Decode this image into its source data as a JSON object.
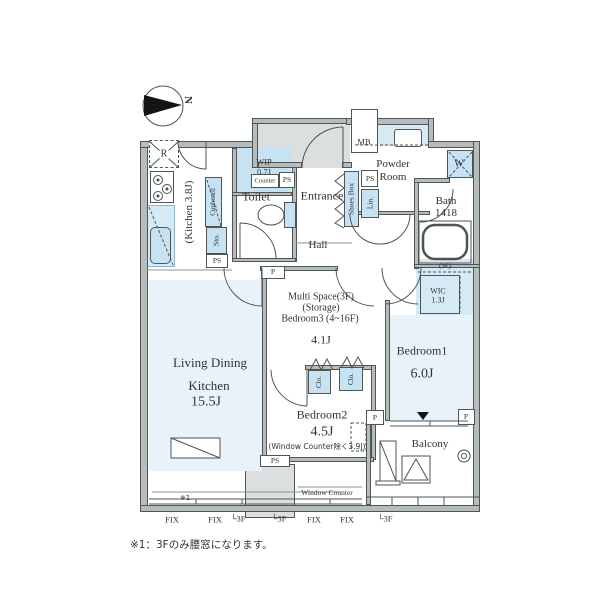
{
  "compass": {
    "north_label": "N"
  },
  "rooms": {
    "ldk": {
      "line1": "Living Dining",
      "line2": "Kitchen",
      "size": "15.5J"
    },
    "kitchen": {
      "label": "(Kitchen 3.8J)"
    },
    "wip": {
      "label": "WIP",
      "size": "0.7J"
    },
    "toilet": {
      "label": "Toilet"
    },
    "entrance": {
      "label": "Entrance"
    },
    "hall": {
      "label": "Hall"
    },
    "powder_room": {
      "line1": "Powder",
      "line2": "Room"
    },
    "bath": {
      "label": "Bath",
      "size": "1418"
    },
    "multi_space": {
      "line1": "Multi Space(3F)",
      "line2": "(Storage)",
      "line3": "Bedroom3 (4~16F)",
      "size": "4.1J"
    },
    "bedroom1": {
      "label": "Bedroom1",
      "size": "6.0J"
    },
    "bedroom2": {
      "label": "Bedroom2",
      "size": "4.5J",
      "note": "(Window Counter除く3.9J)"
    },
    "wic": {
      "hanger_label": "(W)",
      "label": "WIC",
      "size": "1.3J"
    },
    "balcony": {
      "label": "Balcony"
    }
  },
  "fixtures": {
    "refrigerator": "R",
    "meter_box": "MB",
    "washer": "W",
    "cupboard": "Cupboard",
    "shoes_box": "Shoes Box",
    "storage": "Sto.",
    "linen": "Lin.",
    "closet": "Clo.",
    "counter": "Counter",
    "pipe_space": "PS",
    "pillar": "P",
    "window_counter": "Window Counter"
  },
  "annotations": {
    "mark1": "※1",
    "footnote": "※1：3Fのみ腰窓になります。",
    "window_labels": [
      "FIX",
      "FIX",
      "└3F",
      "└3F",
      "FIX",
      "FIX",
      "└3F"
    ]
  }
}
